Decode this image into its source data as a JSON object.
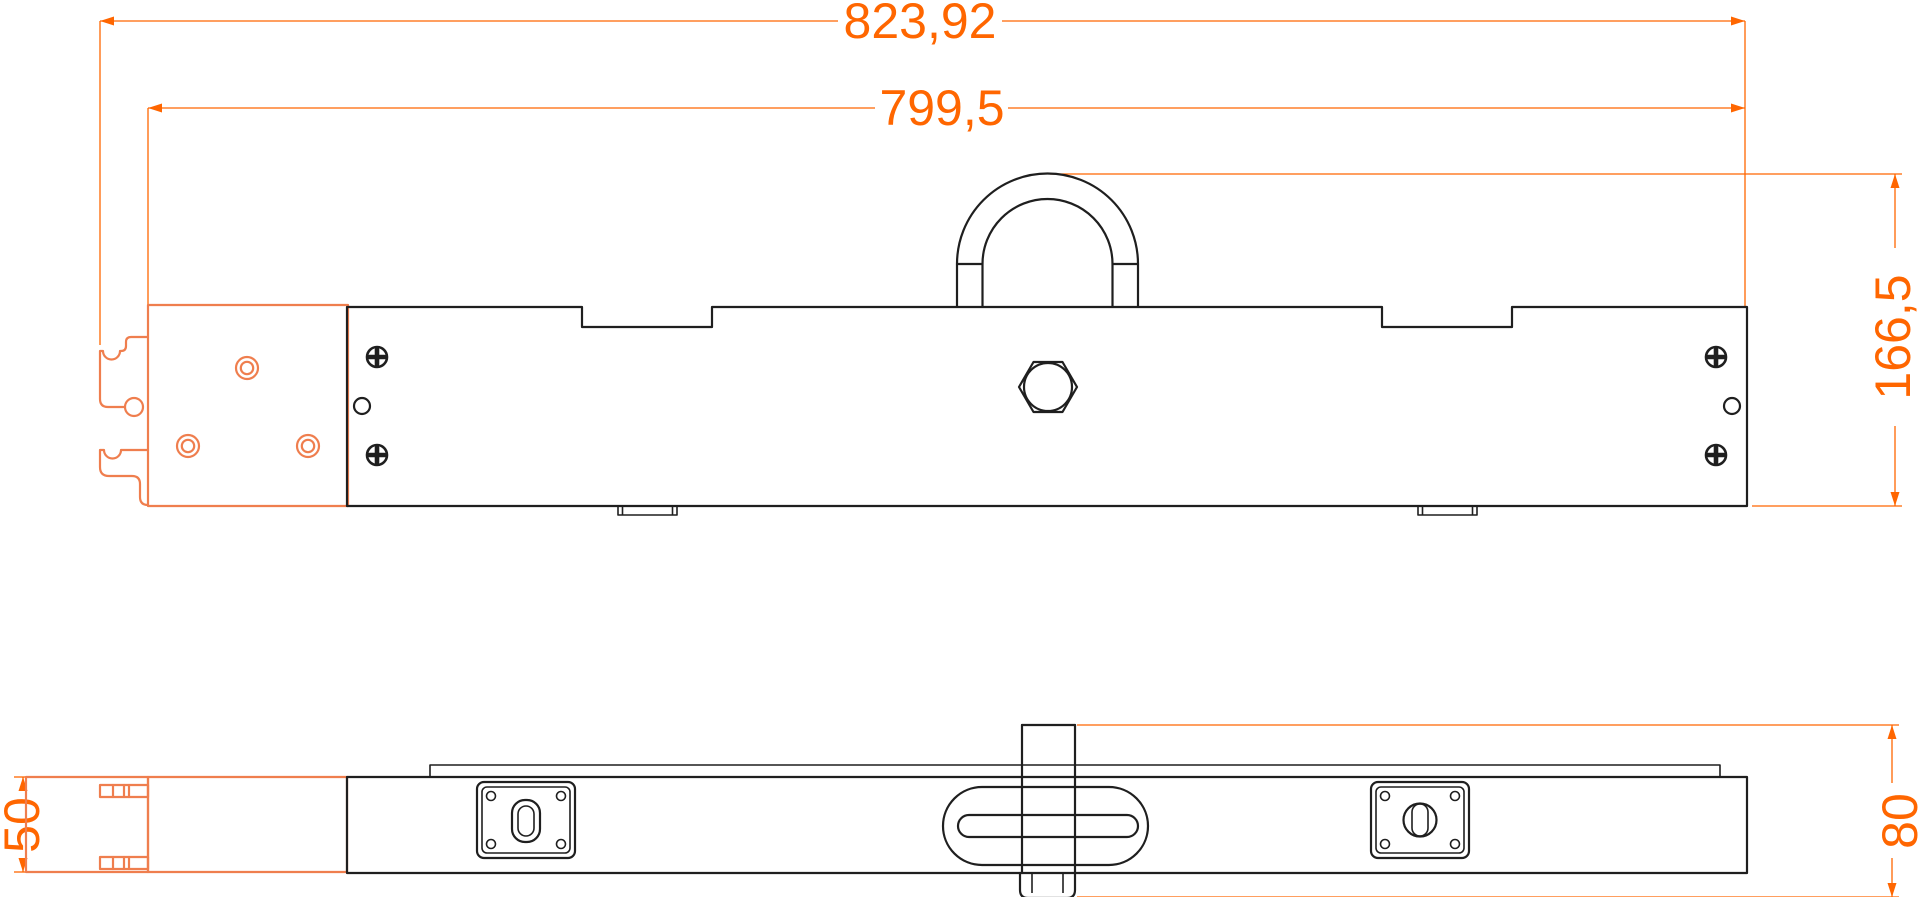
{
  "drawing": {
    "kind": "technical-drawing",
    "views": {
      "top_view_name": "front-elevation",
      "bottom_view_name": "bottom-view"
    },
    "dimensions": {
      "overall_width": "823,92",
      "body_width": "799,5",
      "total_height": "166,5",
      "end_thickness": "50",
      "center_height": "80"
    },
    "colors": {
      "dimension_lines": "#ff6600",
      "phantom_part": "#ef7e4e",
      "part_outline": "#1f1f1f",
      "background": "#ffffff"
    }
  }
}
